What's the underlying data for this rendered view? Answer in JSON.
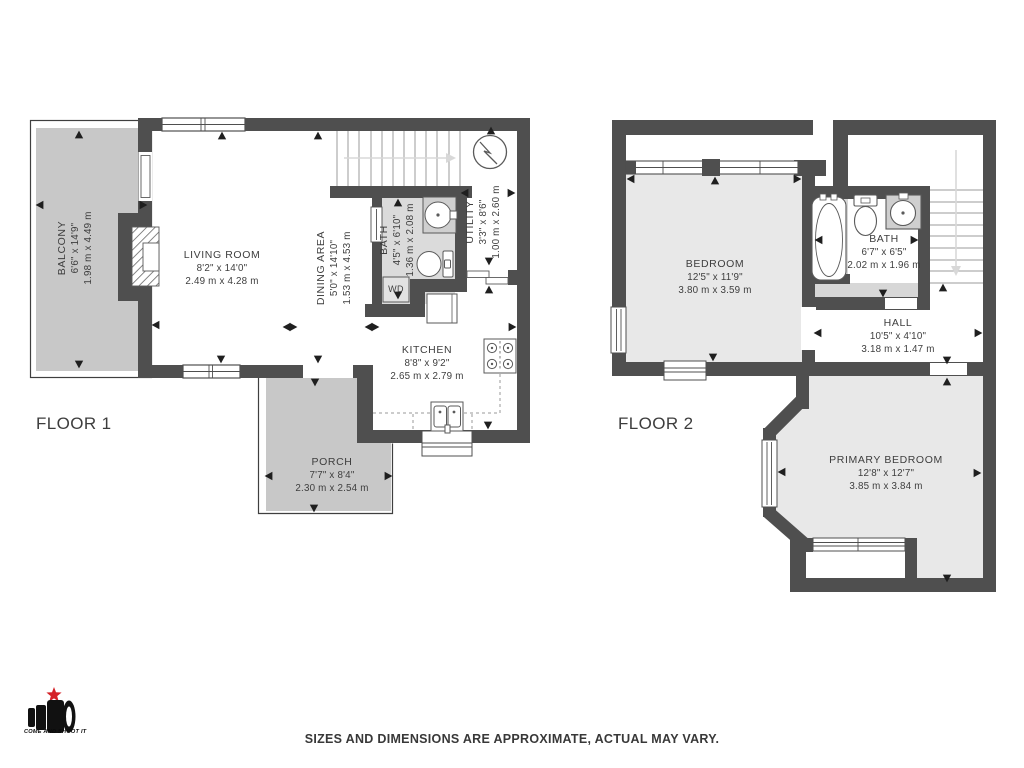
{
  "floor1": {
    "label": "FLOOR 1",
    "rooms": {
      "balcony": {
        "name": "BALCONY",
        "imperial": "6'6\" x 14'9\"",
        "metric": "1.98 m x 4.49 m"
      },
      "living_room": {
        "name": "LIVING ROOM",
        "imperial": "8'2\" x 14'0\"",
        "metric": "2.49 m x 4.28 m"
      },
      "dining_area": {
        "name": "DINING AREA",
        "imperial": "5'0\" x 14'10\"",
        "metric": "1.53 m x 4.53 m"
      },
      "bath": {
        "name": "BATH",
        "imperial": "4'5\" x 6'10\"",
        "metric": "1.36 m x 2.08 m"
      },
      "utility": {
        "name": "UTILITY",
        "imperial": "3'3\" x 8'6\"",
        "metric": "1.00 m x 2.60 m"
      },
      "kitchen": {
        "name": "KITCHEN",
        "imperial": "8'8\" x 9'2\"",
        "metric": "2.65 m x 2.79 m"
      },
      "porch": {
        "name": "PORCH",
        "imperial": "7'7\" x 8'4\"",
        "metric": "2.30 m x 2.54 m"
      },
      "washer_dryer": {
        "label": "WD"
      }
    }
  },
  "floor2": {
    "label": "FLOOR 2",
    "rooms": {
      "bedroom": {
        "name": "BEDROOM",
        "imperial": "12'5\" x 11'9\"",
        "metric": "3.80 m x 3.59 m"
      },
      "bath": {
        "name": "BATH",
        "imperial": "6'7\" x 6'5\"",
        "metric": "2.02 m x 1.96 m"
      },
      "hall": {
        "name": "HALL",
        "imperial": "10'5\" x 4'10\"",
        "metric": "3.18 m x 1.47 m"
      },
      "primary_bedroom": {
        "name": "PRIMARY BEDROOM",
        "imperial": "12'8\" x 12'7\"",
        "metric": "3.85 m x 3.84 m"
      }
    }
  },
  "branding": {
    "logo_text": "COME AND SHOOT IT"
  },
  "footer": {
    "disclaimer": "SIZES AND DIMENSIONS ARE APPROXIMATE, ACTUAL MAY VARY."
  },
  "colors": {
    "wall": "#4f4f4f",
    "outdoor_fill": "#c8c8c8",
    "bath_fill": "#dbdbdb",
    "bedroom_fill": "#e8e8e8",
    "logo_star": "#d42127"
  }
}
